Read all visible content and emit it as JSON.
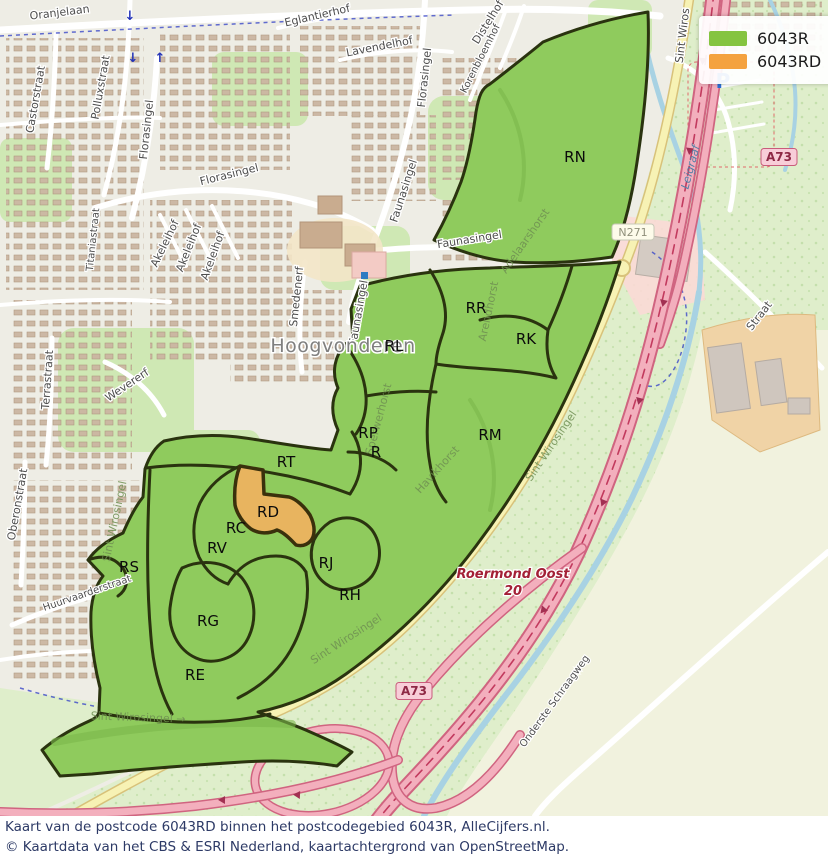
{
  "legend": {
    "items": [
      {
        "label": "6043R",
        "color": "#85c440"
      },
      {
        "label": "6043RD",
        "color": "#f4a23f"
      }
    ]
  },
  "caption": {
    "line1": "Kaart van de postcode 6043RD binnen het postcodegebied 6043R, AlleCijfers.nl.",
    "line2": "© Kaartdata van het CBS & ESRI Nederland, kaartachtergrond van OpenStreetMap."
  },
  "colors": {
    "region_fill": "#8fcb5d",
    "region_stroke": "#2a330f",
    "highlight_fill": "#e8b45f",
    "highlight_stroke": "#3a300c",
    "motorway_fill": "#f3afbd",
    "motorway_casing": "#d06480",
    "secondary_road": "#f7f2b4",
    "water": "#a8d2e3"
  },
  "map": {
    "place": {
      "t": "Hoogvonderen",
      "x": 343,
      "y": 352
    },
    "water_label": {
      "t": "Leigraaf",
      "x": 694,
      "y": 168,
      "r": -75
    },
    "parking": {
      "t": "P",
      "x": 723,
      "y": 88
    },
    "exit": {
      "l1": "Roermond Oost",
      "l2": "20",
      "x": 513,
      "y": 578
    },
    "streets": [
      {
        "t": "Oranjelaan",
        "x": 60,
        "y": 16,
        "r": -7
      },
      {
        "t": "Castorstraat",
        "x": 39,
        "y": 100,
        "r": -80
      },
      {
        "t": "Polluxstraat",
        "x": 104,
        "y": 88,
        "r": -80
      },
      {
        "t": "Florasingel",
        "x": 150,
        "y": 130,
        "r": -84
      },
      {
        "t": "Florasingel",
        "x": 230,
        "y": 178,
        "r": -14
      },
      {
        "t": "Eglantierhof",
        "x": 318,
        "y": 19,
        "r": -13
      },
      {
        "t": "Lavendelhof",
        "x": 380,
        "y": 50,
        "r": -11
      },
      {
        "t": "Florasingel",
        "x": 428,
        "y": 78,
        "r": -84
      },
      {
        "t": "Faunasingel",
        "x": 407,
        "y": 192,
        "r": -72
      },
      {
        "t": "Korenbloemhof",
        "x": 483,
        "y": 60,
        "r": -63
      },
      {
        "t": "Distelhof",
        "x": 491,
        "y": 24,
        "r": -58
      },
      {
        "t": "Sint Wiros",
        "x": 686,
        "y": 36,
        "r": -83
      },
      {
        "t": "Faunasingel",
        "x": 470,
        "y": 243,
        "r": -9
      },
      {
        "t": "Faunasingel",
        "x": 362,
        "y": 313,
        "r": -80
      },
      {
        "t": "Smedenerf",
        "x": 300,
        "y": 297,
        "r": -84
      },
      {
        "t": "Titaniastraat",
        "x": 96,
        "y": 240,
        "r": -84
      },
      {
        "t": "Akeleihof",
        "x": 168,
        "y": 245,
        "r": -64
      },
      {
        "t": "Akeleihof",
        "x": 192,
        "y": 249,
        "r": -68
      },
      {
        "t": "Akeleihof",
        "x": 216,
        "y": 257,
        "r": -70
      },
      {
        "t": "Terrastraat",
        "x": 51,
        "y": 380,
        "r": -86
      },
      {
        "t": "Wevererf",
        "x": 129,
        "y": 388,
        "r": -34
      },
      {
        "t": "Oberonstraat",
        "x": 21,
        "y": 505,
        "r": -80
      },
      {
        "t": "Huurvaarderstraat",
        "x": 88,
        "y": 596,
        "r": -19
      },
      {
        "t": "Straat",
        "x": 762,
        "y": 318,
        "r": -52
      },
      {
        "t": "Onderste Schraagweg",
        "x": 557,
        "y": 703,
        "r": -54
      }
    ],
    "area_streets": [
      {
        "t": "Adelaarshorst",
        "x": 528,
        "y": 243,
        "r": -55
      },
      {
        "t": "Arendhorst",
        "x": 492,
        "y": 312,
        "r": -78
      },
      {
        "t": "Sperwerhorst",
        "x": 382,
        "y": 420,
        "r": -75
      },
      {
        "t": "Havikhorst",
        "x": 440,
        "y": 472,
        "r": -48
      },
      {
        "t": "Sint Wirosingel",
        "x": 554,
        "y": 448,
        "r": -56
      },
      {
        "t": "Sint Wirosingel",
        "x": 118,
        "y": 522,
        "r": -78
      },
      {
        "t": "Sint Wirosingel",
        "x": 348,
        "y": 642,
        "r": -33
      },
      {
        "t": "Sint Wirosingel →",
        "x": 138,
        "y": 721,
        "r": 2
      }
    ],
    "region_labels": [
      {
        "t": "RN",
        "x": 575,
        "y": 162
      },
      {
        "t": "RR",
        "x": 476,
        "y": 313
      },
      {
        "t": "RK",
        "x": 526,
        "y": 344
      },
      {
        "t": "RL",
        "x": 394,
        "y": 351
      },
      {
        "t": "RP",
        "x": 368,
        "y": 438
      },
      {
        "t": "R",
        "x": 376,
        "y": 457
      },
      {
        "t": "RM",
        "x": 490,
        "y": 440
      },
      {
        "t": "RT",
        "x": 286,
        "y": 467
      },
      {
        "t": "RD",
        "x": 268,
        "y": 517
      },
      {
        "t": "RC",
        "x": 236,
        "y": 533
      },
      {
        "t": "RV",
        "x": 217,
        "y": 553
      },
      {
        "t": "RJ",
        "x": 326,
        "y": 568
      },
      {
        "t": "RH",
        "x": 350,
        "y": 600
      },
      {
        "t": "RS",
        "x": 129,
        "y": 572
      },
      {
        "t": "RG",
        "x": 208,
        "y": 626
      },
      {
        "t": "RE",
        "x": 195,
        "y": 680
      }
    ],
    "shields": [
      {
        "t": "A73",
        "x": 779,
        "y": 157,
        "type": "motorway"
      },
      {
        "t": "A73",
        "x": 414,
        "y": 691,
        "type": "motorway"
      },
      {
        "t": "N271",
        "x": 633,
        "y": 232,
        "type": "national"
      }
    ]
  }
}
